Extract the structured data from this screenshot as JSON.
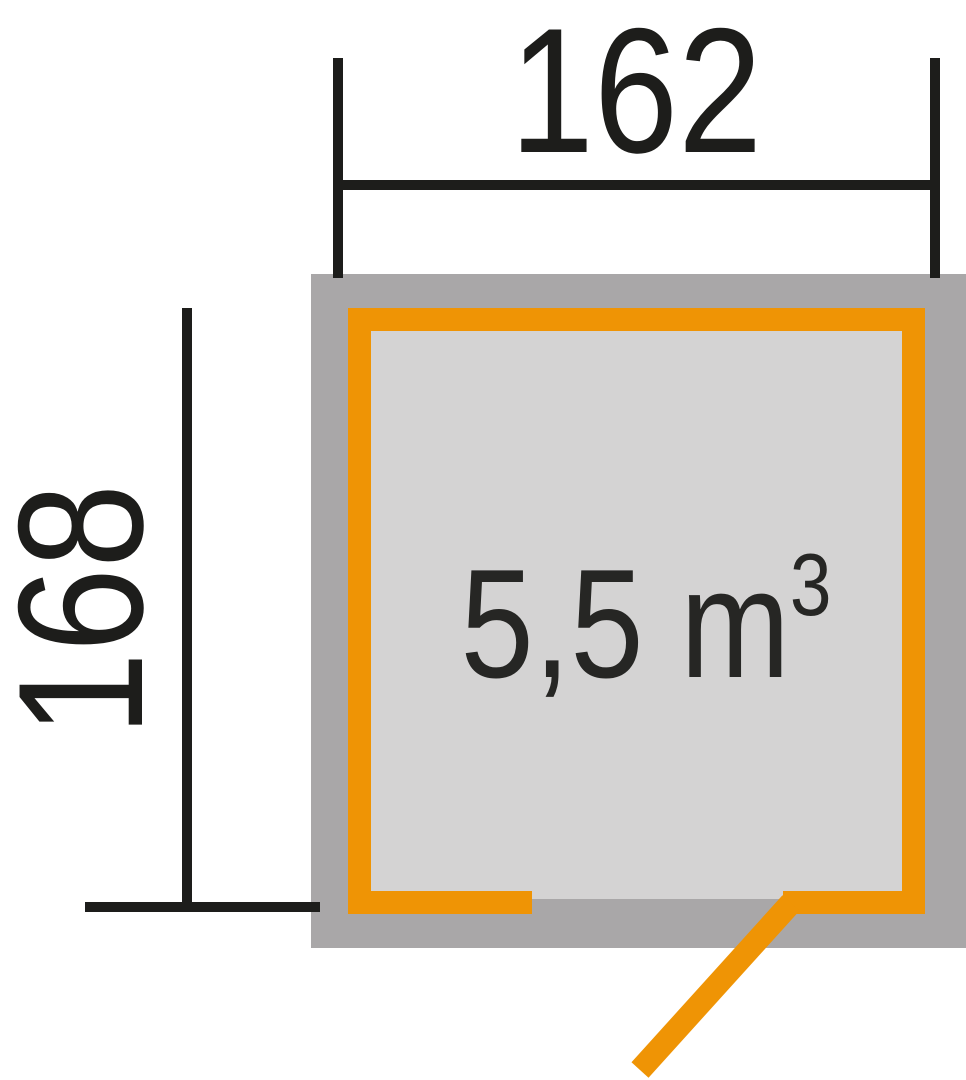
{
  "plan": {
    "width_label": "162",
    "height_label": "168",
    "volume": {
      "base": "5,5 m",
      "exponent": "3",
      "display": "5,5 m³"
    },
    "colors": {
      "orange": "#ef9405",
      "wall_gray": "#a9a7a8",
      "interior_gray": "#d4d3d3",
      "dimension_black": "#1d1d1b",
      "volume_text": "#262624",
      "background": "#ffffff"
    }
  }
}
